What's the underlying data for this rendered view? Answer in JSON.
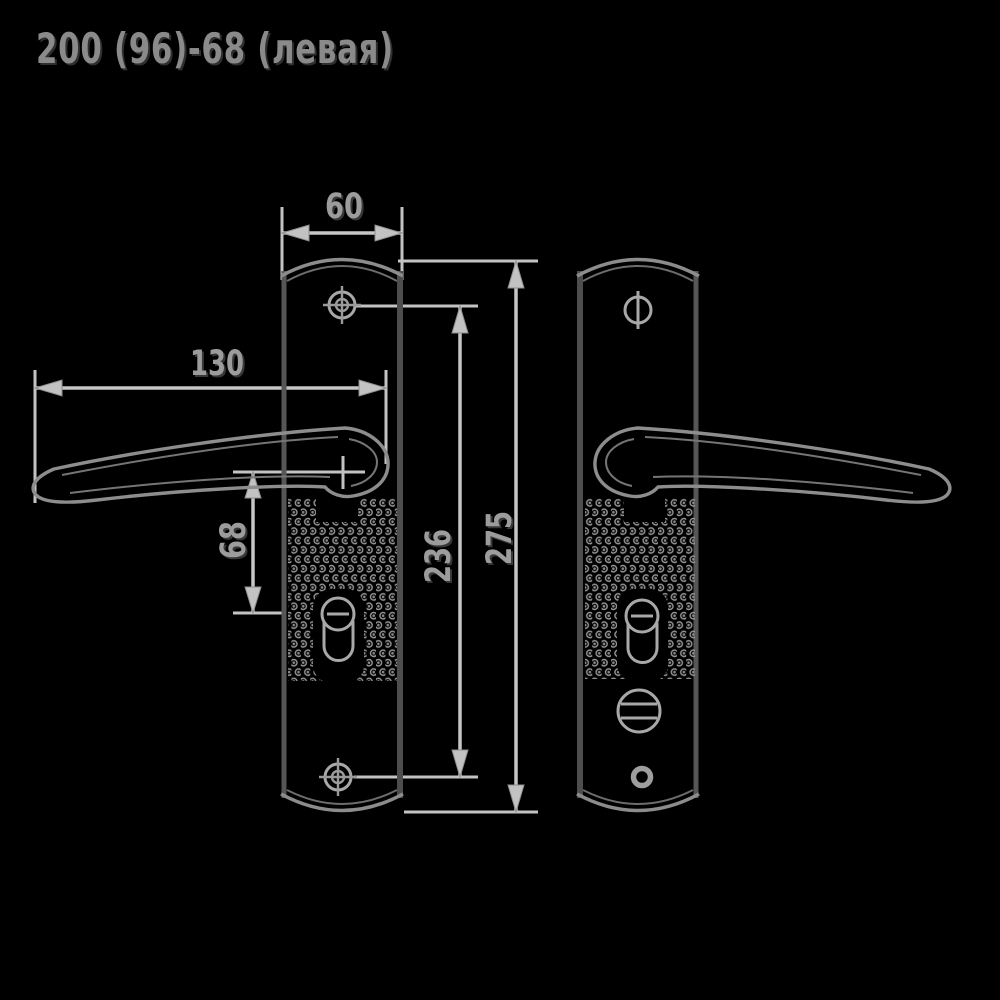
{
  "title": "200 (96)-68 (левая)",
  "dimensions": {
    "plate_width": "60",
    "handle_length": "130",
    "handle_axis_to_cylinder": "68",
    "screw_spacing": "236",
    "plate_height": "275"
  },
  "colors": {
    "background": "#000000",
    "dimension_lines": "#c6c6c6",
    "plate_edge": "#565656",
    "plate_arc": "#8c8c8c",
    "handle_outline": "#8d8d8d",
    "texture_dots": "#969696",
    "label_text": "#9c9c9c",
    "title_text": "#8a8a8a"
  }
}
